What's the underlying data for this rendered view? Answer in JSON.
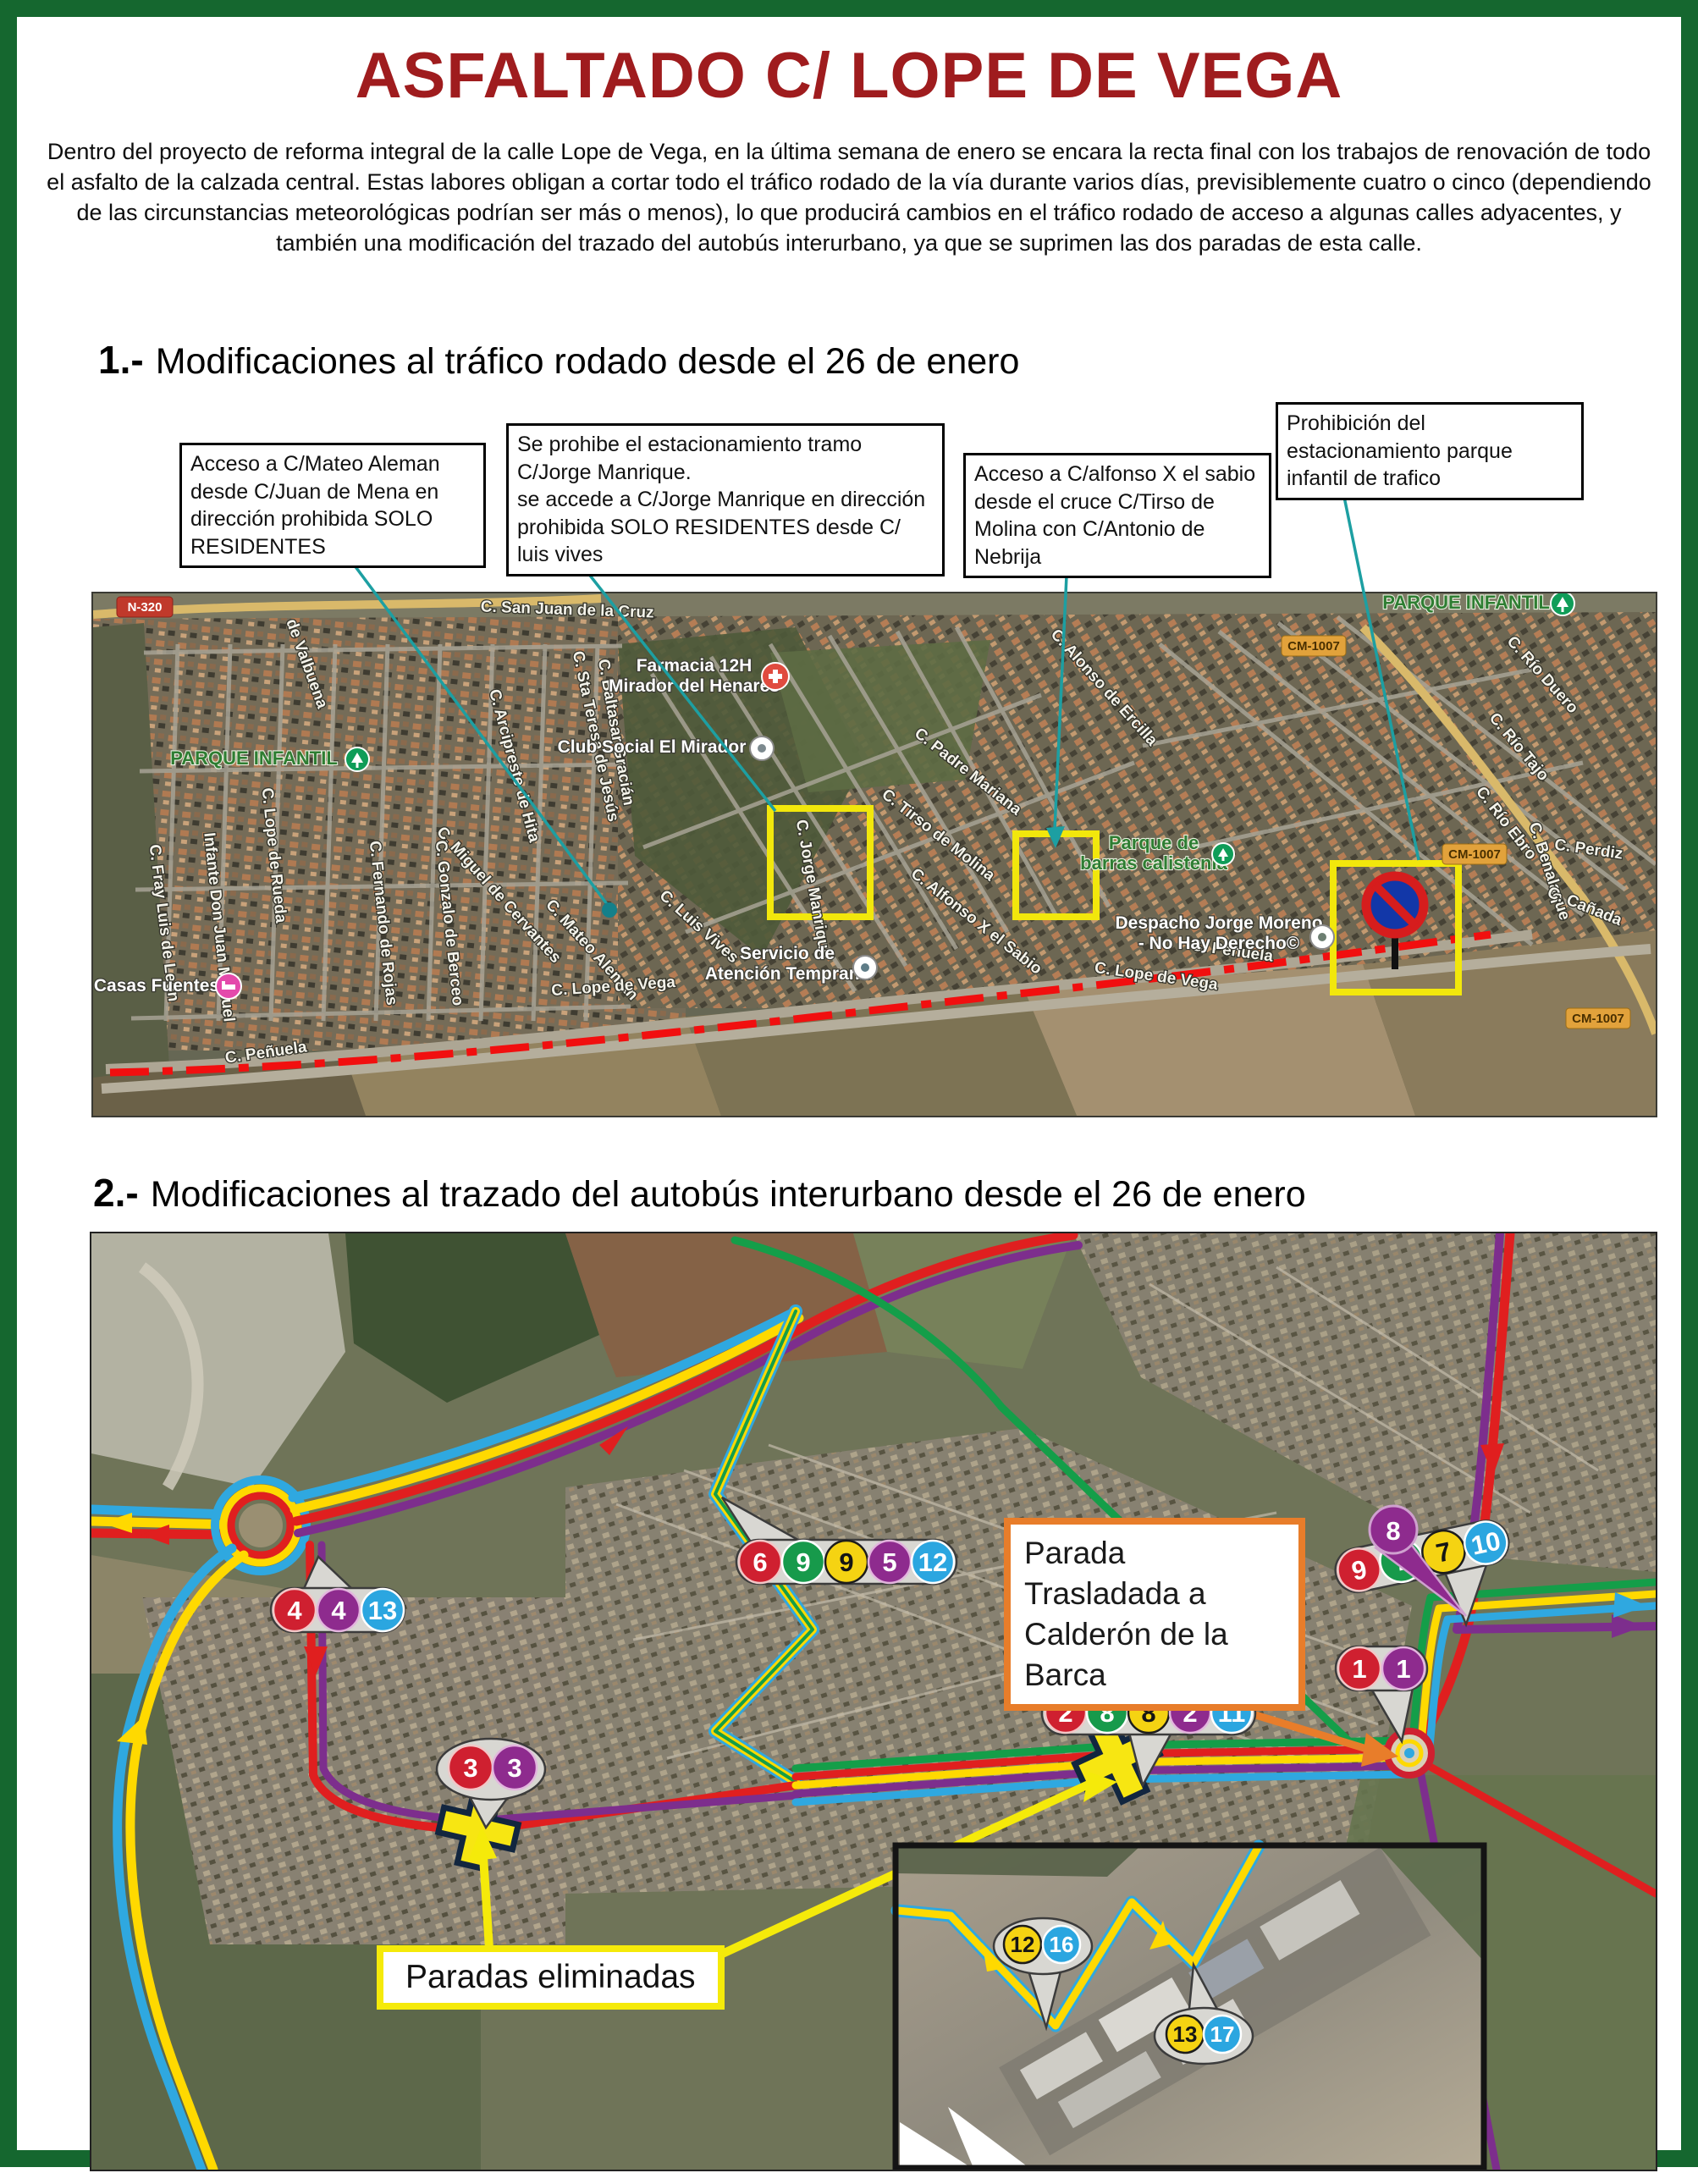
{
  "title": "ASFALTADO C/ LOPE DE VEGA",
  "intro": "Dentro del proyecto de reforma integral de la calle Lope de Vega, en la última semana de enero se encara la recta final con los trabajos de renovación de todo el asfalto de la calzada central. Estas labores obligan a cortar todo el tráfico rodado de la vía durante varios días, previsiblemente cuatro o cinco (dependiendo de las circunstancias meteorológicas podrían ser más o menos), lo que producirá cambios en el tráfico rodado de acceso a algunas calles adyacentes, y también una modificación del trazado del autobús interurbano, ya que se suprimen las dos paradas de esta calle.",
  "section1": {
    "number": "1.-",
    "title": "Modificaciones al tráfico rodado desde el 26 de enero"
  },
  "section2": {
    "number": "2.-",
    "title": "Modificaciones al trazado del autobús interurbano desde el 26 de enero"
  },
  "callouts": {
    "mateo_aleman": "Acceso a C/Mateo Aleman desde C/Juan de Mena en dirección prohibida SOLO RESIDENTES",
    "jorge_manrique": "Se prohibe el estacionamiento tramo C/Jorge Manrique.\nse accede a C/Jorge Manrique en dirección prohibida SOLO RESIDENTES desde C/ luis vives",
    "alfonso_x": "Acceso a C/alfonso X el sabio desde el cruce C/Tirso de Molina con C/Antonio de Nebrija",
    "parque_infantil": "Prohibición del estacionamiento parque infantil de trafico",
    "parada_trasladada": "Parada Trasladada a Calderón de la Barca",
    "paradas_eliminadas": "Paradas eliminadas"
  },
  "map1": {
    "badges": [
      {
        "label": "N-320"
      },
      {
        "label": "CM-1007"
      },
      {
        "label": "CM-1007"
      },
      {
        "label": "CM-1007"
      }
    ],
    "green_labels": [
      {
        "label": "PARQUE INFANTIL"
      },
      {
        "label": "PARQUE INFANTIL"
      },
      {
        "line1": "Parque de",
        "line2": "barras calistenia"
      }
    ],
    "pois": [
      {
        "line1": "Farmacia 12H",
        "line2": "Mirador del Henares"
      },
      {
        "line1": "Club Social El Mirador"
      },
      {
        "line1": "Servicio de",
        "line2": "Atención Temprana"
      },
      {
        "line1": "Despacho Jorge Moreno",
        "line2": "- No Hay Derecho©"
      },
      {
        "line1": "Casas Fuentes"
      }
    ],
    "streets": [
      "C. San Juan de la Cruz",
      "C. Sta Teresa de Jesús",
      "C. Arcipreste de Hita",
      "C. Miguel de Cervantes",
      "C. Mateo Alemán",
      "C. Fray Luis de León",
      "Infante Don Juan Manuel",
      "C. Lope de Rueda",
      "de Valbuena",
      "C. Fernando de Rojas",
      "C. Gonzalo de Berceo",
      "C. Baltasar Gracián",
      "C. Luis Vives",
      "C. Jorge Manrique",
      "C. Padre Mariana",
      "C. Tirso de Molina",
      "C. Alfonso X el Sabio",
      "C. Alonso de Ercilla",
      "C. Río Duero",
      "C. Río Tajo",
      "C. Río Ebro",
      "C. Benalaque",
      "C. Perdiz",
      "C. Cañada",
      "C. Peñuela",
      "C. Peñuela",
      "C. Lope de Vega",
      "C. Lope de Vega"
    ]
  },
  "map2": {
    "clusters": [
      {
        "name": "oeste",
        "stops": [
          {
            "n": "4",
            "c": "red"
          },
          {
            "n": "4",
            "c": "purple"
          },
          {
            "n": "13",
            "c": "blue"
          }
        ]
      },
      {
        "name": "centro-norte",
        "stops": [
          {
            "n": "6",
            "c": "red"
          },
          {
            "n": "9",
            "c": "green"
          },
          {
            "n": "9",
            "c": "yellow"
          },
          {
            "n": "5",
            "c": "purple"
          },
          {
            "n": "12",
            "c": "blue"
          }
        ]
      },
      {
        "name": "este-norte",
        "stops": [
          {
            "n": "9",
            "c": "red"
          },
          {
            "n": "7",
            "c": "green"
          },
          {
            "n": "7",
            "c": "yellow"
          },
          {
            "n": "10",
            "c": "blue"
          }
        ]
      },
      {
        "name": "este",
        "stops": [
          {
            "n": "1",
            "c": "red"
          },
          {
            "n": "1",
            "c": "purple"
          }
        ]
      },
      {
        "name": "centro",
        "stops": [
          {
            "n": "2",
            "c": "red"
          },
          {
            "n": "8",
            "c": "green"
          },
          {
            "n": "8",
            "c": "yellow"
          },
          {
            "n": "2",
            "c": "purple"
          },
          {
            "n": "11",
            "c": "blue"
          }
        ]
      },
      {
        "name": "suroeste",
        "stops": [
          {
            "n": "3",
            "c": "red"
          },
          {
            "n": "3",
            "c": "purple"
          }
        ]
      },
      {
        "name": "pin-8",
        "stops": [
          {
            "n": "8",
            "c": "purple"
          }
        ]
      }
    ],
    "inset_markers": [
      {
        "n": "12",
        "c": "yellow"
      },
      {
        "n": "16",
        "c": "blue"
      },
      {
        "n": "13",
        "c": "yellow"
      },
      {
        "n": "17",
        "c": "blue"
      }
    ]
  },
  "colors": {
    "border_green": "#15672f",
    "title_red": "#9f1c1e",
    "callout_teal": "#1d9fa2",
    "route_red": "#e01f1f",
    "route_yellow": "#ffd900",
    "route_blue": "#2fa8e0",
    "route_purple": "#7d2e8d",
    "route_green": "#149e49",
    "orange": "#e87d2a",
    "highlight_yellow": "#f5ea0a",
    "stop_red": "#cf2030",
    "stop_green": "#179a4b",
    "stop_yellow": "#f5d312",
    "stop_purple": "#8e2b8e",
    "stop_blue": "#2ba6e0"
  }
}
